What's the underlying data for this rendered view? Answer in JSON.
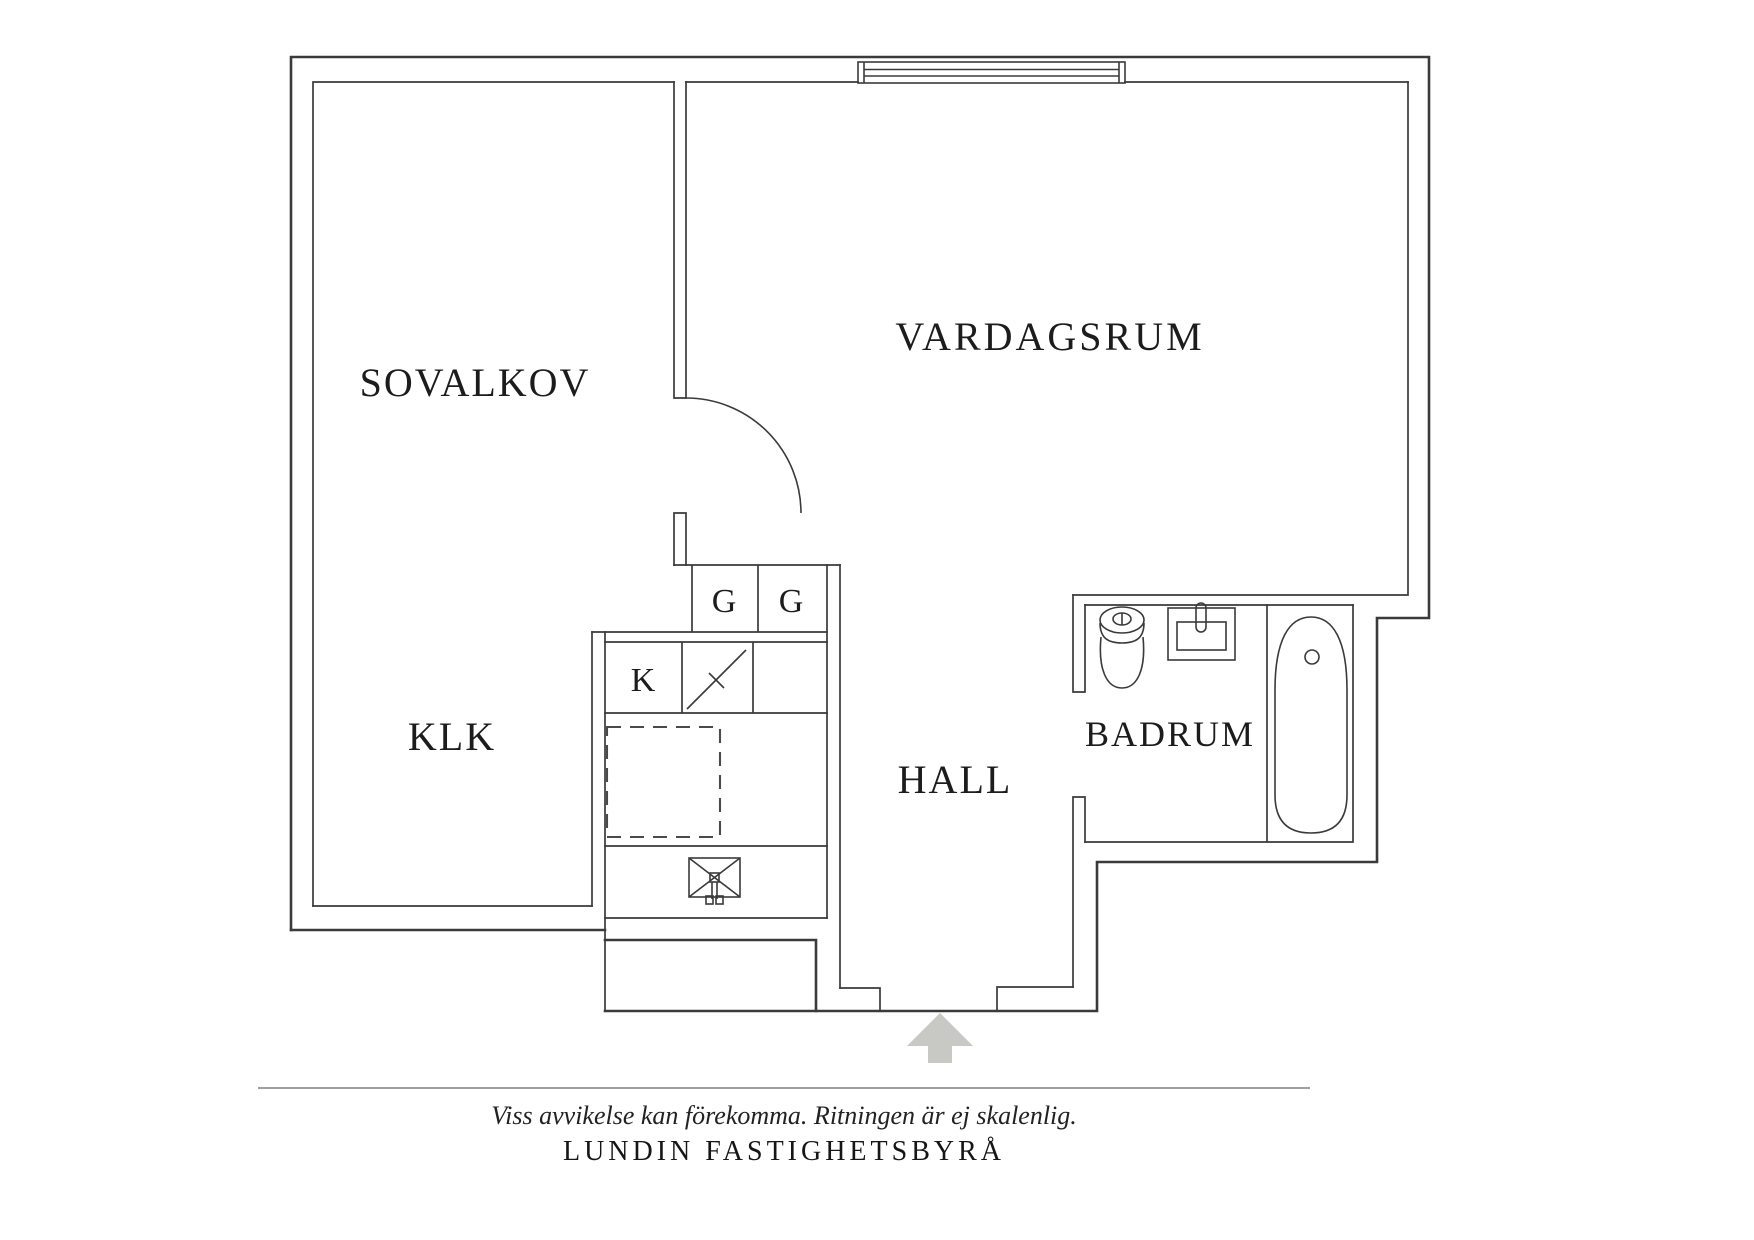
{
  "rooms": {
    "sovalkov": "SOVALKOV",
    "vardagsrum": "VARDAGSRUM",
    "klk": "KLK",
    "hall": "HALL",
    "badrum": "BADRUM",
    "g1": "G",
    "g2": "G",
    "k": "K"
  },
  "footer": {
    "disclaimer": "Viss avvikelse kan förekomma. Ritningen är ej skalenlig.",
    "agency": "LUNDIN FASTIGHETSBYRÅ"
  },
  "colors": {
    "wall": "#3a3a3a",
    "arrow_fill": "#c8c8c5",
    "arrow_border": "#9b9b98",
    "text": "#1c1c1c"
  }
}
